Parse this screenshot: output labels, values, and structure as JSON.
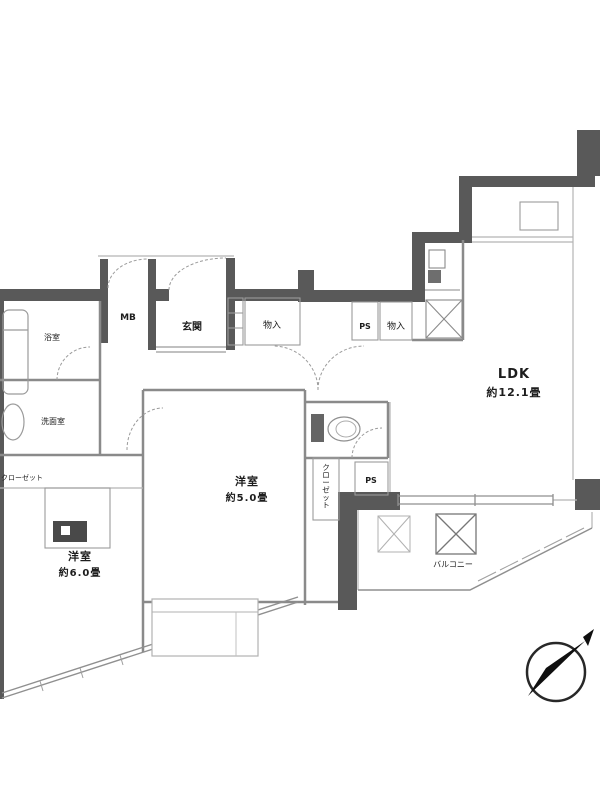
{
  "floorplan": {
    "rooms": {
      "ldk": {
        "name": "LDK",
        "size": "約12.1畳"
      },
      "bedroom5": {
        "name": "洋室",
        "size": "約5.0畳"
      },
      "bedroom6": {
        "name": "洋室",
        "size": "約6.0畳"
      },
      "entrance": {
        "label": "玄関"
      },
      "washroom": {
        "label": "洗面室"
      },
      "bath": {
        "label": "浴室"
      },
      "balcony": {
        "label": "バルコニー"
      }
    },
    "labels": {
      "mb": "MB",
      "ps_upper": "PS",
      "ps_mid": "PS",
      "storage_entry": "物入",
      "storage_kitchen": "物入",
      "closet_vertical": "クローゼット",
      "closet_left": "クローゼット"
    },
    "colors": {
      "wall": "#5a5a5a",
      "line_medium": "#8a8a8a",
      "line_light": "#b3b3b3",
      "text": "#1f1f1f"
    }
  }
}
